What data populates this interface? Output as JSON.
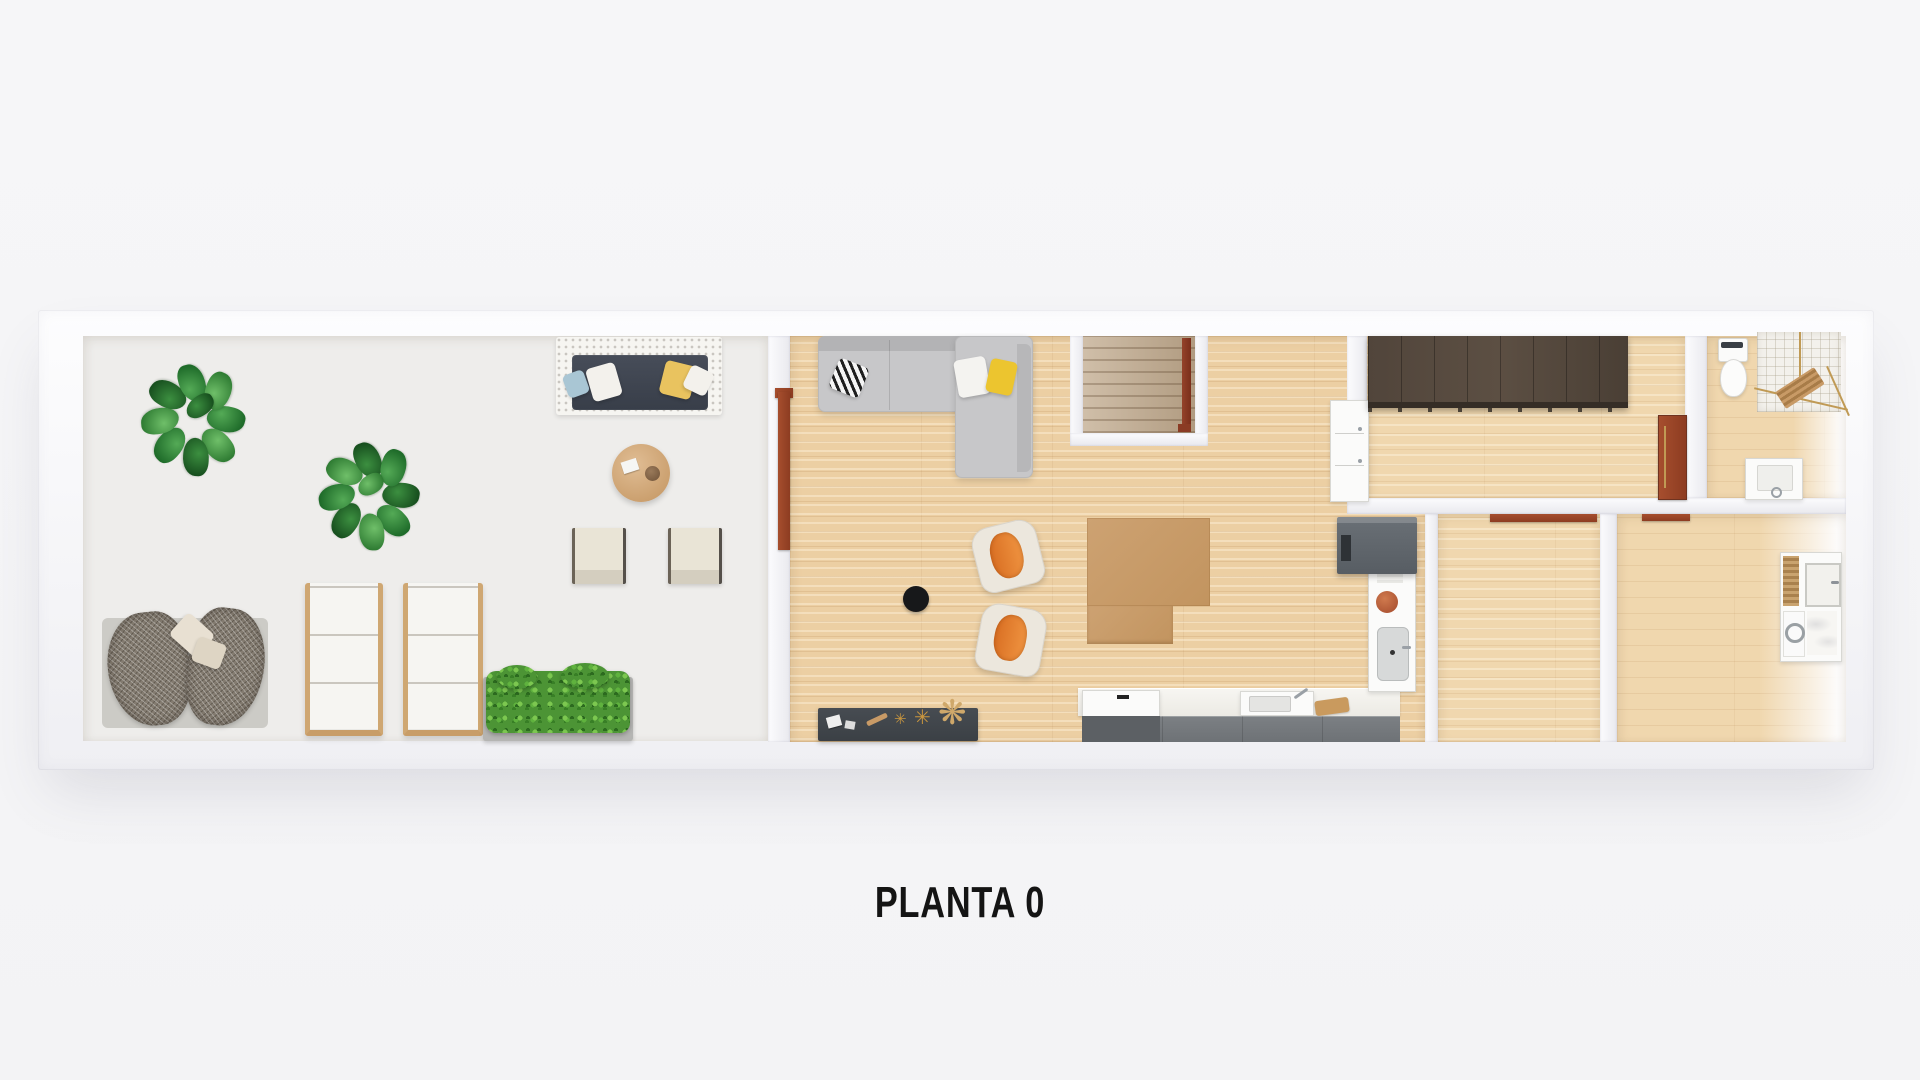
{
  "title": {
    "label": "PLANTA 0"
  },
  "palette": {
    "background": "#f4f4f6",
    "wall": "#f7f7fa",
    "wood_floor": "#eccfa3",
    "wood_floor_light": "#f0d7ae",
    "gravel": "#eeedeb",
    "outdoor_sofa_dark": "#3f4450",
    "sofa_gray": "#c7c7c9",
    "cushion_blue": "#a9c6d4",
    "cushion_yellow": "#e9c35f",
    "pillow_yellow": "#ecc52f",
    "armchair_orange": "#e07f2e",
    "table_tan": "#c99d6b",
    "counter_gray": "#75797d",
    "wardrobe_brown": "#4e433a",
    "door_red": "#a14a2c",
    "plant_green": "#2f7c33",
    "hedge_green": "#4c9435",
    "stair_rail_red": "#8a3b24",
    "rug_black": "#17181a"
  },
  "items": [
    "patio-gravel-garden",
    "potted-plants",
    "outdoor-sofa",
    "outdoor-round-table",
    "outdoor-chairs",
    "wicker-lounge-chair",
    "sun-loungers",
    "planter-hedge",
    "sectional-sofa",
    "armchairs",
    "center-table",
    "round-rug",
    "decor-sideboard",
    "staircase",
    "kitchen-counter",
    "kitchen-sink",
    "tall-cabinet",
    "gray-appliance",
    "wardrobe-closet",
    "interior-doors",
    "toilet",
    "corner-shower",
    "bathroom-sink",
    "washer-dryer-unit"
  ]
}
